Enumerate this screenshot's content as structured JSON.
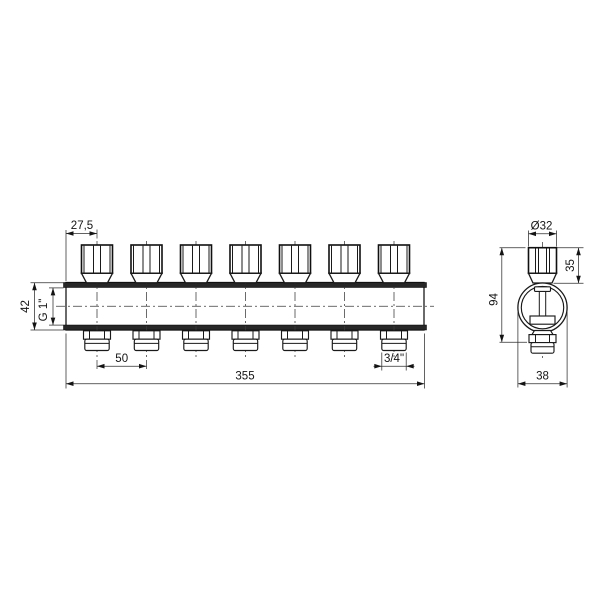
{
  "meta": {
    "description": "Technical line drawing of a 7-outlet heating manifold with valve caps, front view and side section view",
    "valve_count": 7,
    "views": [
      "front",
      "side"
    ]
  },
  "colors": {
    "line": "#1a1a1a",
    "band": "#272727",
    "background": "#ffffff"
  },
  "front_view": {
    "dims": {
      "first_valve_offset": "27,5",
      "manifold_height": "42",
      "inlet_thread": "G 1\"",
      "outlet_spacing": "50",
      "outlet_thread": "3/4\"",
      "total_length": "355"
    }
  },
  "side_view": {
    "dims": {
      "cap_diameter": "Ø32",
      "cap_height": "35",
      "overall_height": "94",
      "body_width": "38"
    }
  }
}
